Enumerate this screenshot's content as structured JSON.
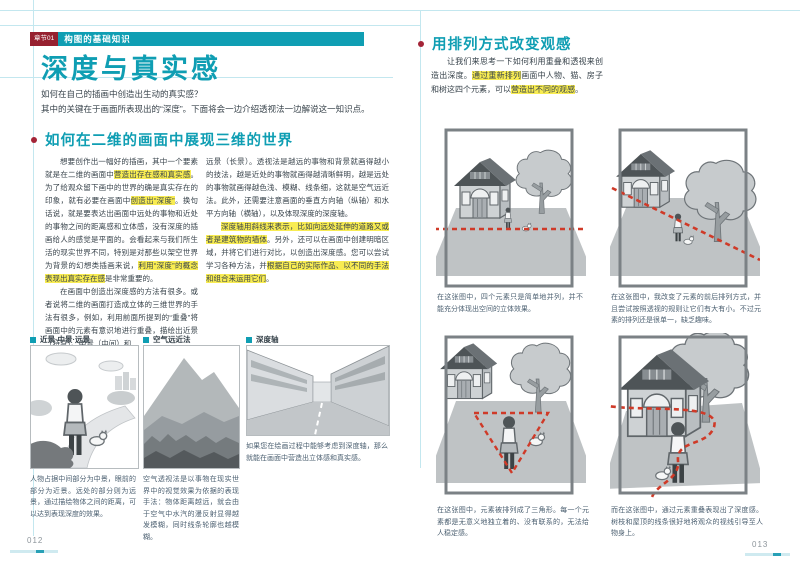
{
  "colors": {
    "accent": "#0f9eb3",
    "chapter_tag_red": "#96202f",
    "bullet_red": "#a32437",
    "highlight_yellow": "#f8ec52",
    "dashed_line_red": "#cf3a28",
    "guide_line_cyan": "#c3e7ef"
  },
  "left_page": {
    "chapter_tag": "章节01",
    "chapter_title": "构图的基础知识",
    "title": "深度与真实感",
    "intro": [
      "如何在自己的插画中创造出生动的真实感？",
      "其中的关键在于画面所表现出的“深度”。下面将会一边介绍透视法一边解说这一知识点。"
    ],
    "section_heading": "如何在二维的画面中展现三维的世界",
    "col1_p1": [
      {
        "t": "想要创作出一幅好的插画，其中一个要素就是在二维的画面中"
      },
      {
        "t": "营造出存在感和真实感",
        "hl": true
      },
      {
        "t": "。为了给观众留下画中的世界的确是真实存在的印象，就有必要在画面中"
      },
      {
        "t": "创造出“深度”",
        "hl": true
      },
      {
        "t": "。换句话说，就是要表达出画面中远处的事物和近处的事物之间的距离感和立体感，没有深度的插画给人的感觉是平面的。会看起来与我们所生活的现实世界不同，特别是对那些以架空世界为背景的幻想类插画来说，"
      },
      {
        "t": "利用“深度”的概念表现出真实存在感",
        "hl": true
      },
      {
        "t": "是非常重要的。"
      }
    ],
    "col1_p2": [
      {
        "t": "在画面中创造出深度感的方法有很多。或者说将二维的画面打造成立体的三维世界的手法有很多，例如，利用前面所提到的“重叠”将画面中的元素有意识地进行重叠，描绘出近景（特写）、中景（中间）和"
      }
    ],
    "col2_p1": [
      {
        "t": "远景（长景）。透视法是越远的事物和背景就画得越小的技法，越是近处的事物就画得越清晰鲜明，越是远处的事物就画得越色浅、模糊、线条细，这就是空气远近法。此外，还需要注意画面的垂直方向轴（纵轴）和水平方向轴（横轴），以及体现深度的深度轴。"
      }
    ],
    "col2_p2": [
      {
        "t": "深度轴用斜线来表示，比如向远处延伸的道路又或者是建筑物的墙体",
        "hl": true
      },
      {
        "t": "。另外，还可以在画面中创建明暗区域，并将它们进行对比，以创造出深度感。您可以尝试学习各种方法，并"
      },
      {
        "t": "根据自己的实际作品、以不同的手法和组合来运用它们",
        "hl": true
      },
      {
        "t": "。"
      }
    ],
    "figures": [
      {
        "label": "近景·中景·远景",
        "caption": "人物占据中间部分为中景，眼前的部分为近景。远处的部分则为远景，通过描绘物体之间的距离，可以达到表现深度的效果。"
      },
      {
        "label": "空气远近法",
        "caption": "空气透视法是以事物在现实世界中的视觉效果为依据的表现手法：物体距离越远，就会由于空气中水汽的漫反射显得越发模糊，同时线条轮廓也越模糊。"
      },
      {
        "label": "深度轴",
        "caption": "如果您在绘画过程中能够考虑到深度轴，那么就能在画面中营造出立体感和真实感。"
      }
    ],
    "page_number": "012"
  },
  "right_page": {
    "section_heading": "用排列方式改变观感",
    "intro": [
      {
        "t": "让我们来思考一下如何利用重叠和透视来创造出深度。"
      },
      {
        "t": "通过重新排列",
        "hl": true
      },
      {
        "t": "画面中人物、猫、房子和树这四个元素，可以"
      },
      {
        "t": "营造出不同的观感",
        "hl": true
      },
      {
        "t": "。"
      }
    ],
    "figures": [
      {
        "caption": "在这张图中，四个元素只是简单地并列，并不能充分体现出空间的立体效果。"
      },
      {
        "caption": "在这张图中，我改变了元素的前后排列方式，并且尝试按照透视的规则让它们有大有小。不过元素的排列还是很单一，缺乏趣味。"
      },
      {
        "caption": "在这张图中，元素被排列成了三角形。每一个元素都是无意义地独立着的、没有联系的，无法给人稳定感。"
      },
      {
        "caption": "而在这张图中，通过元素重叠表现出了深度感。树枝和屋顶的线条很好地将观众的视线引导至人物身上。"
      }
    ],
    "page_number": "013"
  }
}
